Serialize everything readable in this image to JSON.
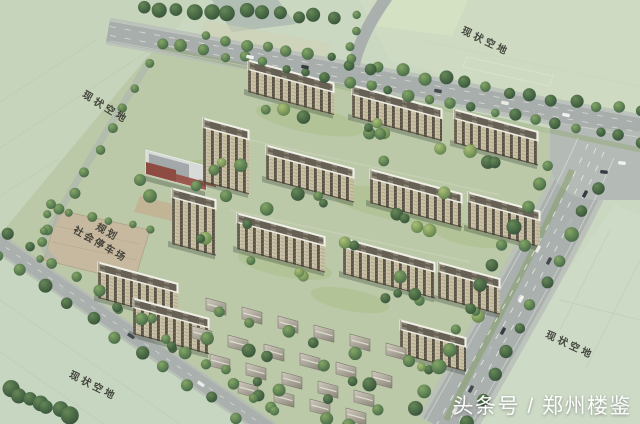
{
  "labels": {
    "vacant_top_left": "现状空地",
    "vacant_top_right": "现状空地",
    "vacant_bottom_left": "现状空地",
    "vacant_bottom_right": "现状空地",
    "parking_line1": "规划",
    "parking_line2": "社会停车场"
  },
  "watermark": {
    "text": "头条号 / 郑州楼鉴"
  },
  "palette": {
    "vacant_land": "#c9d6bf",
    "site_ground": "#b9c7a5",
    "road": "#a7acaa",
    "road_edge": "#b8bcb7",
    "intersection": "#b2b7b3",
    "lane_marking": "#f2f2ee",
    "tree_dark": "#2e4c32",
    "tree_mid": "#3f6340",
    "tree_light": "#5c7f45",
    "building_facade": "#c8bc9f",
    "building_stripe": "#4f4839",
    "roof_light": "#ecebe2",
    "roof_panel": "#5f594c",
    "parking_lot": "#c4b69c",
    "school_red": "#8a4238",
    "villa_roof": "#a9a396",
    "label_text": "#2e2e28",
    "watermark_text": "#ffffff"
  }
}
